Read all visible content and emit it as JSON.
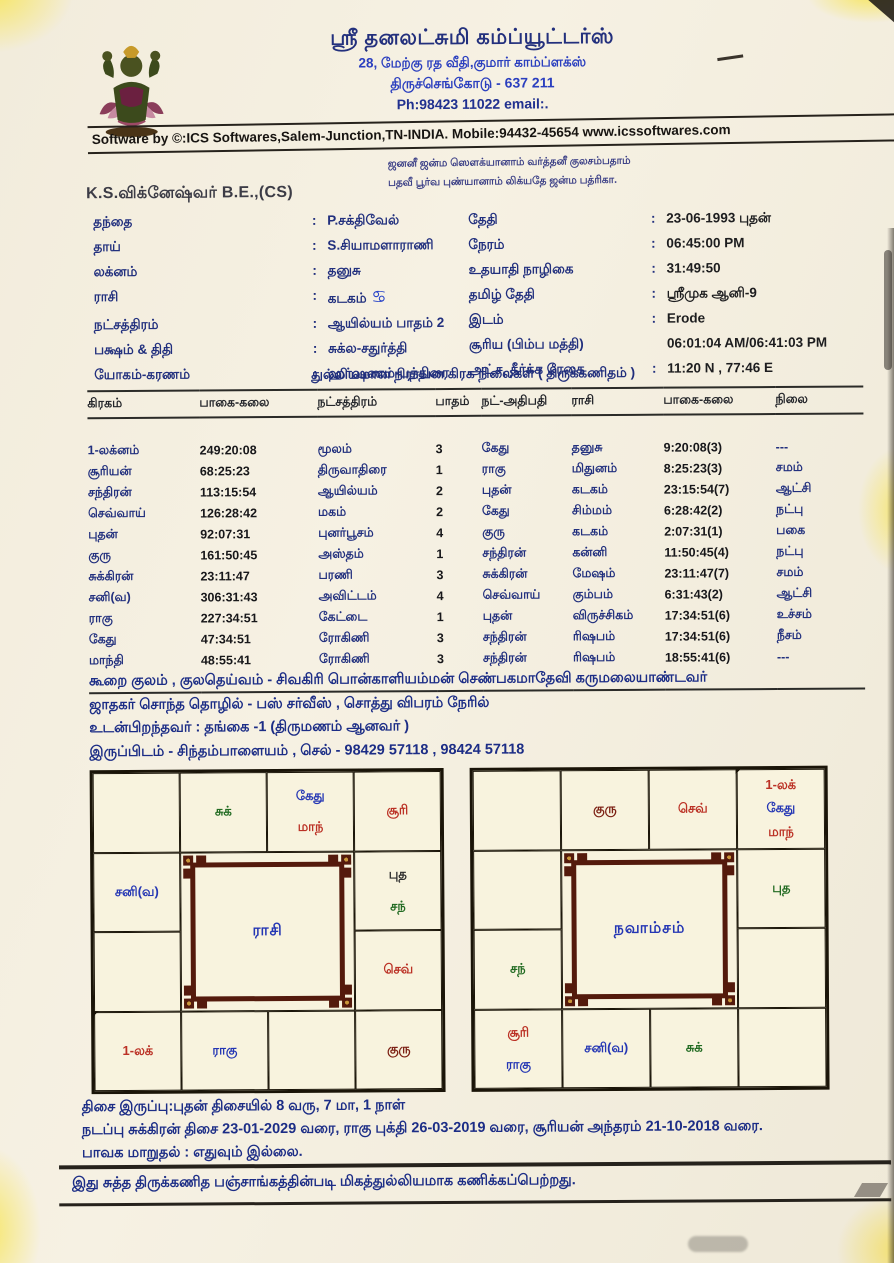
{
  "header": {
    "company": "ஸ்ரீ தனலட்சுமி கம்ப்யூட்டர்ஸ்",
    "address1": "28, மேற்கு ரத வீதி,குமார் காம்ப்ளக்ஸ்",
    "address2": "திருச்செங்கோடு - 637 211",
    "phone": "Ph:98423 11022 email:.",
    "software_line": "Software by ©:ICS Softwares,Salem-Junction,TN-INDIA. Mobile:94432-45654 www.icssoftwares.com",
    "shloka1": "ஜனனீ ஜன்ம ஸௌக்யானாம் வர்த்தனீ குலசம்பதாம்",
    "shloka2": "பதவீ பூர்வ புண்யானாம் லிக்யதே ஜன்ம பத்ரிகா.",
    "name": "K.S.விக்னேஷ்வர் B.E.,(CS)"
  },
  "details": {
    "left": [
      {
        "label": "தந்தை",
        "colon": ":",
        "value": "P.சக்திவேல்"
      },
      {
        "label": "தாய்",
        "colon": ":",
        "value": "S.சியாமளாராணி"
      },
      {
        "label": "லக்னம்",
        "colon": ":",
        "value": "தனுசு"
      },
      {
        "label": "ராசி",
        "colon": ":",
        "value": "கடகம்",
        "symbol": "♋"
      },
      {
        "label": "நட்சத்திரம்",
        "colon": ":",
        "value": "ஆயில்யம் பாதம்  2"
      },
      {
        "label": "பக்ஷம் & திதி",
        "colon": ":",
        "value": "சுக்ல-சதுர்த்தி"
      },
      {
        "label": "யோகம்-கரணம்",
        "colon": ":",
        "value": "ஹர்ஷணம்-பத்திரை"
      }
    ],
    "right": [
      {
        "label": "தேதி",
        "colon": ":",
        "value": "23-06-1993 புதன்"
      },
      {
        "label": "நேரம்",
        "colon": ":",
        "value": "06:45:00 PM"
      },
      {
        "label": "உதயாதி நாழிகை",
        "colon": ":",
        "value": "31:49:50"
      },
      {
        "label": "தமிழ் தேதி",
        "colon": ":",
        "value": "ஸ்ரீமுக ஆனி-9"
      },
      {
        "label": "இடம்",
        "colon": ":",
        "value": "Erode"
      },
      {
        "label": "சூரிய (பிம்ப மத்தி)",
        "colon": "",
        "value": "06:01:04 AM/06:41:03 PM"
      },
      {
        "label": "அட்ச, தீர்க்க ரேகை",
        "colon": ":",
        "value": "11:20 N , 77:46 E"
      }
    ]
  },
  "table": {
    "title": "துல்லியமான நிராயன கிரக நிலைகள் ( திருக்கணிதம் )",
    "headers": [
      "கிரகம்",
      "பாகை-கலை",
      "நட்சத்திரம்",
      "பாதம்",
      "நட்-அதிபதி",
      "ராசி",
      "பாகை-கலை",
      "நிலை"
    ],
    "rows": [
      [
        "1-லக்னம்",
        "249:20:08",
        "மூலம்",
        "3",
        "கேது",
        "தனுசு",
        "9:20:08(3)",
        "---"
      ],
      [
        "சூரியன்",
        "68:25:23",
        "திருவாதிரை",
        "1",
        "ராகு",
        "மிதுனம்",
        "8:25:23(3)",
        "சமம்"
      ],
      [
        "சந்திரன்",
        "113:15:54",
        "ஆயில்யம்",
        "2",
        "புதன்",
        "கடகம்",
        "23:15:54(7)",
        "ஆட்சி"
      ],
      [
        "செவ்வாய்",
        "126:28:42",
        "மகம்",
        "2",
        "கேது",
        "சிம்மம்",
        "6:28:42(2)",
        "நட்பு"
      ],
      [
        "புதன்",
        "92:07:31",
        "புனர்பூசம்",
        "4",
        "குரு",
        "கடகம்",
        "2:07:31(1)",
        "பகை"
      ],
      [
        "குரு",
        "161:50:45",
        "அஸ்தம்",
        "1",
        "சந்திரன்",
        "கன்னி",
        "11:50:45(4)",
        "நட்பு"
      ],
      [
        "சுக்கிரன்",
        "23:11:47",
        "பரணி",
        "3",
        "சுக்கிரன்",
        "மேஷம்",
        "23:11:47(7)",
        "சமம்"
      ],
      [
        "சனி(வ)",
        "306:31:43",
        "அவிட்டம்",
        "4",
        "செவ்வாய்",
        "கும்பம்",
        "6:31:43(2)",
        "ஆட்சி"
      ],
      [
        "ராகு",
        "227:34:51",
        "கேட்டை",
        "1",
        "புதன்",
        "விருச்சிகம்",
        "17:34:51(6)",
        "உச்சம்"
      ],
      [
        "கேது",
        "47:34:51",
        "ரோகிணி",
        "3",
        "சந்திரன்",
        "ரிஷபம்",
        "17:34:51(6)",
        "நீசம்"
      ],
      [
        "மாந்தி",
        "48:55:41",
        "ரோகிணி",
        "3",
        "சந்திரன்",
        "ரிஷபம்",
        "18:55:41(6)",
        "---"
      ]
    ]
  },
  "notes": [
    "கூறை குலம் , குலதெய்வம் - சிவகிரி பொன்காளியம்மன் செண்பகமாதேவி கருமலையாண்டவர்",
    "ஜாதகர் சொந்த தொழில் - பஸ் சர்வீஸ் , சொத்து விபரம் நேரில்",
    "உடன்பிறந்தவர் : தங்கை -1 (திருமணம் ஆனவர் )",
    "இருப்பிடம் - சிந்தம்பாளையம் , செல் - 98429 57118 , 98424 57118"
  ],
  "colors": {
    "navy": "#22307e",
    "blue": "#2436b4",
    "red": "#bb3125",
    "green": "#226b22",
    "maroon": "#7c2014",
    "dark": "#2b2b2b"
  },
  "charts": [
    {
      "id": "rasi",
      "title": "ராசி",
      "cells": [
        {
          "items": []
        },
        {
          "items": [
            {
              "t": "சுக்",
              "c": "#226b22"
            }
          ]
        },
        {
          "items": [
            {
              "t": "கேது",
              "c": "#2436b4"
            },
            {
              "t": "மாந்",
              "c": "#bb3125"
            }
          ]
        },
        {
          "items": [
            {
              "t": "சூரி",
              "c": "#bb3125"
            }
          ]
        },
        {
          "items": [
            {
              "t": "சனி(வ)",
              "c": "#2436b4"
            }
          ]
        },
        {
          "items": [
            {
              "t": "புத",
              "c": "#2b2b2b"
            },
            {
              "t": "சந்",
              "c": "#226b22"
            }
          ]
        },
        {
          "items": []
        },
        {
          "items": [
            {
              "t": "செவ்",
              "c": "#bb3125"
            }
          ]
        },
        {
          "diag": true,
          "items": [
            {
              "t": "1-லக்",
              "c": "#bb3125"
            }
          ]
        },
        {
          "items": [
            {
              "t": "ராகு",
              "c": "#2436b4"
            }
          ]
        },
        {
          "items": []
        },
        {
          "items": [
            {
              "t": "குரு",
              "c": "#7c2014"
            }
          ]
        }
      ]
    },
    {
      "id": "navamsam",
      "title": "நவாம்சம்",
      "cells": [
        {
          "items": []
        },
        {
          "items": [
            {
              "t": "குரு",
              "c": "#7c2014"
            }
          ]
        },
        {
          "items": [
            {
              "t": "செவ்",
              "c": "#bb3125"
            }
          ]
        },
        {
          "diag": true,
          "items": [
            {
              "t": "1-லக்",
              "c": "#bb3125"
            },
            {
              "t": "கேது",
              "c": "#2436b4"
            },
            {
              "t": "மாந்",
              "c": "#bb3125"
            }
          ]
        },
        {
          "items": []
        },
        {
          "items": [
            {
              "t": "புத",
              "c": "#226b22"
            }
          ]
        },
        {
          "items": [
            {
              "t": "சந்",
              "c": "#226b22"
            }
          ]
        },
        {
          "items": []
        },
        {
          "items": [
            {
              "t": "சூரி",
              "c": "#bb3125"
            },
            {
              "t": "ராகு",
              "c": "#2436b4"
            }
          ]
        },
        {
          "items": [
            {
              "t": "சனி(வ)",
              "c": "#2436b4"
            }
          ]
        },
        {
          "items": [
            {
              "t": "சுக்",
              "c": "#226b22"
            }
          ]
        },
        {
          "items": []
        }
      ]
    }
  ],
  "dasa": [
    "திசை இருப்பு:புதன் திசையில் 8 வரு, 7 மா, 1 நாள்",
    "நடப்பு சுக்கிரன் திசை 23-01-2029 வரை, ராகு புக்தி 26-03-2019 வரை, சூரியன் அந்தரம் 21-10-2018 வரை.",
    "பாவக மாறுதல் : எதுவும் இல்லை."
  ],
  "footer": "இது சுத்த திருக்கணித பஞ்சாங்கத்தின்படி மிகத்துல்லியமாக கணிக்கப்பெற்றது."
}
